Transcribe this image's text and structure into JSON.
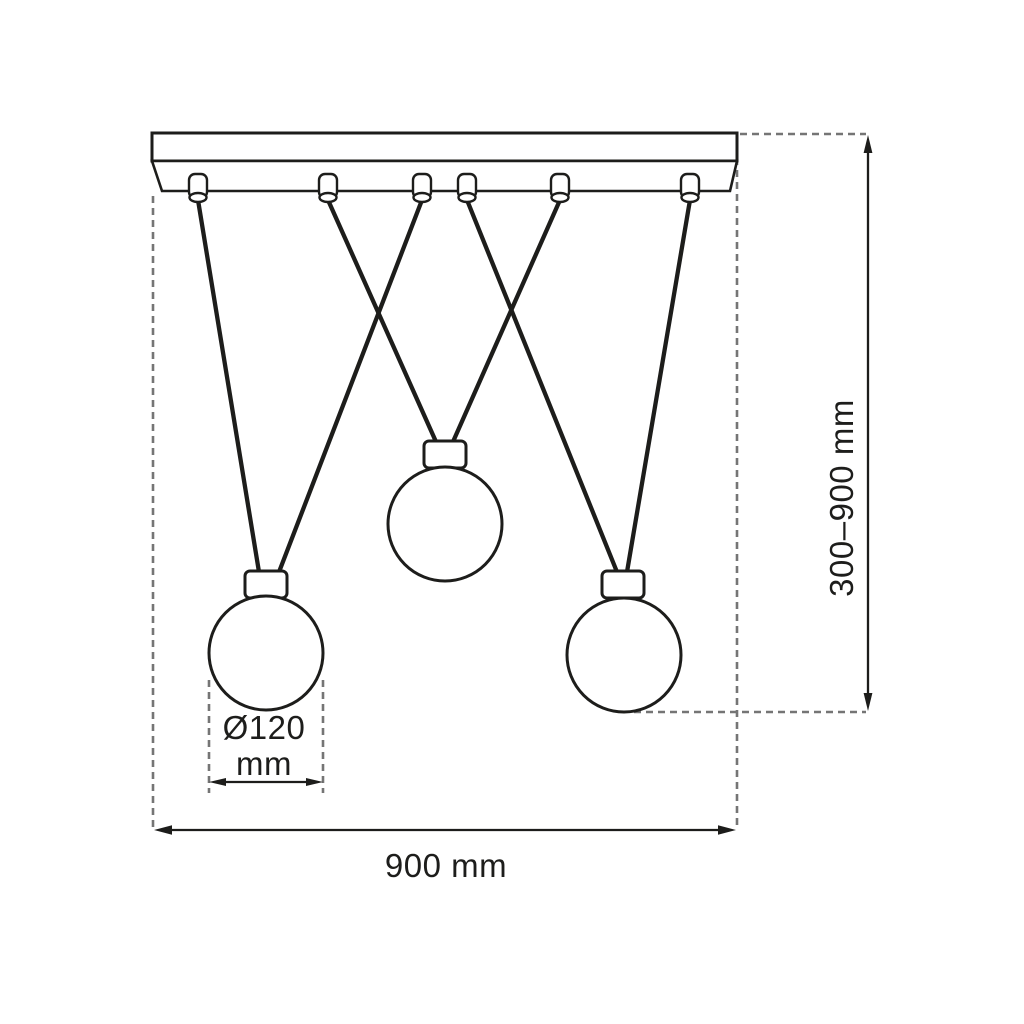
{
  "drawing": {
    "kind": "pendant-lamp-dimension-diagram",
    "labels": {
      "shade_diameter_line1": "Ø120",
      "shade_diameter_line2": "mm",
      "fixture_width": "900 mm",
      "suspension_height": "300–900 mm"
    },
    "dimensions": {
      "shade_diameter_mm": 120,
      "fixture_width_mm": 900,
      "suspension_height_min_mm": 300,
      "suspension_height_max_mm": 900
    },
    "component_counts": {
      "glass_globes": 3,
      "ceiling_cord_grips": 6,
      "suspension_cables": 6
    }
  },
  "colors": {
    "line": "#1d1d1b",
    "dashed": "#757575",
    "background": "#ffffff"
  }
}
